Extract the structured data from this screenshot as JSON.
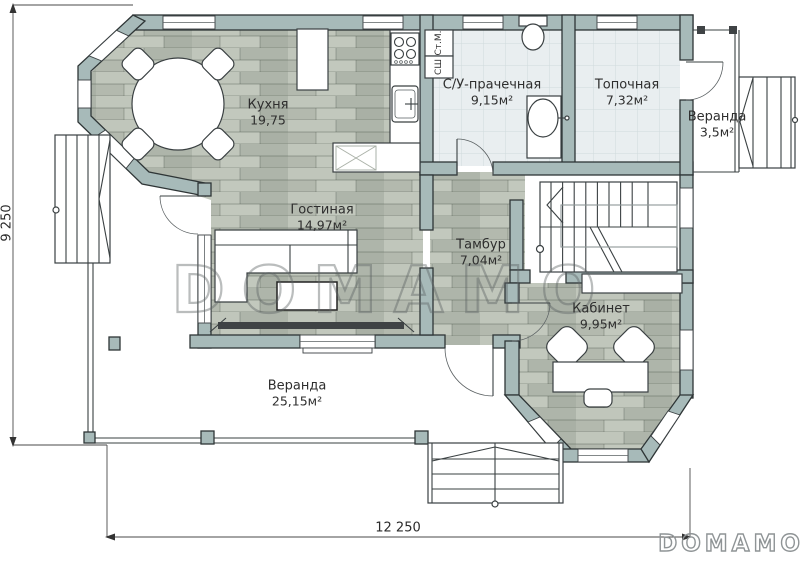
{
  "title": "Floor plan",
  "rooms": [
    {
      "name": "Кухня",
      "area": "19,75"
    },
    {
      "name": "С/У-прачечная",
      "area": "9,15м²"
    },
    {
      "name": "Топочная",
      "area": "7,32м²"
    },
    {
      "name": "Веранда",
      "area": "3,5м²"
    },
    {
      "name": "Гостиная",
      "area": "14,97м²"
    },
    {
      "name": "Тамбур",
      "area": "7,04м²"
    },
    {
      "name": "Кабинет",
      "area": "9,95м²"
    },
    {
      "name": "Веранда",
      "area": "25,15м²"
    }
  ],
  "appliances": [
    {
      "label": "Ст.М."
    },
    {
      "label": "СШ"
    }
  ],
  "dimensions": {
    "width": "12 250",
    "height": "9 250"
  },
  "watermark": {
    "center": "DOMAMO",
    "corner": "DOMAMO"
  },
  "theme": {
    "wall": "#a7bab9",
    "wallOutline": "#2e3536",
    "wood": "#b7beb3",
    "tile": "#e9eef0",
    "tileLine": "#cfdadc",
    "watermark": "#5d6364"
  }
}
